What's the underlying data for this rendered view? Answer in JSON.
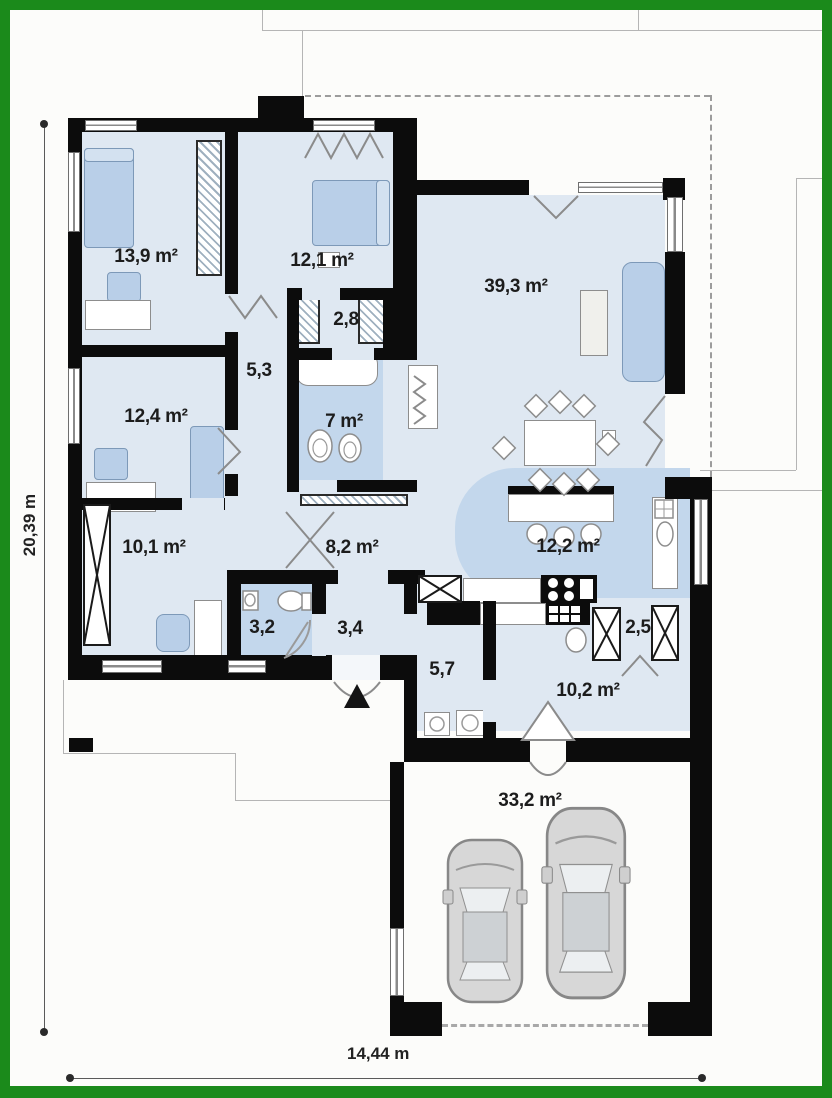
{
  "plan": {
    "rooms": [
      {
        "name": "bedroom-1",
        "label": "13,9 m²"
      },
      {
        "name": "bedroom-2",
        "label": "12,1 m²"
      },
      {
        "name": "wardrobe",
        "label": "2,8"
      },
      {
        "name": "hall-night",
        "label": "5,3"
      },
      {
        "name": "bedroom-3",
        "label": "12,4 m²"
      },
      {
        "name": "bathroom",
        "label": "7 m²"
      },
      {
        "name": "living-room",
        "label": "39,3 m²"
      },
      {
        "name": "bedroom-4",
        "label": "10,1 m²"
      },
      {
        "name": "hall-main",
        "label": "8,2 m²"
      },
      {
        "name": "kitchen",
        "label": "12,2 m²"
      },
      {
        "name": "wc",
        "label": "3,2"
      },
      {
        "name": "entry",
        "label": "3,4"
      },
      {
        "name": "pantry",
        "label": "2,5"
      },
      {
        "name": "utility",
        "label": "5,7"
      },
      {
        "name": "garage-hall",
        "label": "10,2 m²"
      },
      {
        "name": "garage",
        "label": "33,2 m²"
      }
    ],
    "dimensions": {
      "height_label": "20,39 m",
      "width_label": "14,44 m"
    },
    "colors": {
      "frame_green": "#1b8a1b",
      "wall_black": "#0c0c0c",
      "room_fill": "#dfe8f2",
      "wet_room_fill": "#c3d7ec",
      "furniture_blue": "#b9cfe8",
      "car_gray": "#d7d7d7"
    }
  }
}
